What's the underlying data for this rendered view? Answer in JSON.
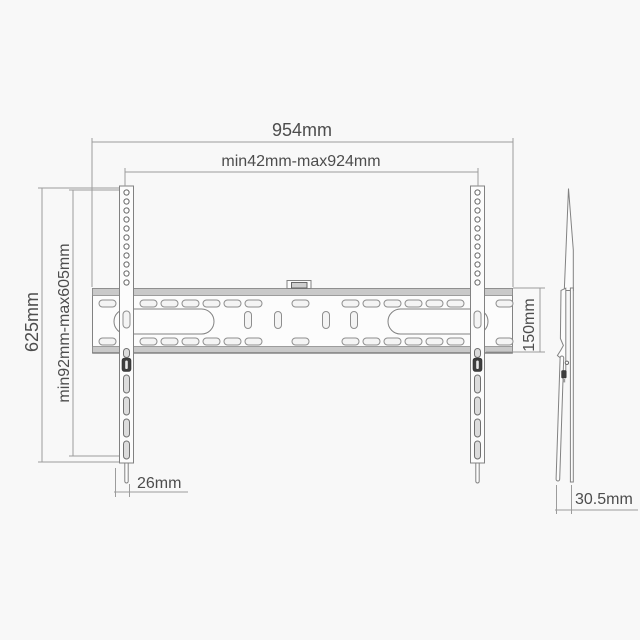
{
  "diagram": {
    "dims": {
      "overall_width": "954mm",
      "mount_width_range": "min42mm-max924mm",
      "overall_height": "625mm",
      "mount_height_range": "min92mm-max605mm",
      "plate_height": "150mm",
      "rail_width": "26mm",
      "depth": "30.5mm"
    },
    "colors": {
      "background": "#f8f8f8",
      "drawing_line": "#828282",
      "dimension_line": "#9c9c9c",
      "text": "#4d4d4d",
      "flange_shade": "#c9c9c9",
      "dark_detail": "#3d3d3d"
    }
  }
}
